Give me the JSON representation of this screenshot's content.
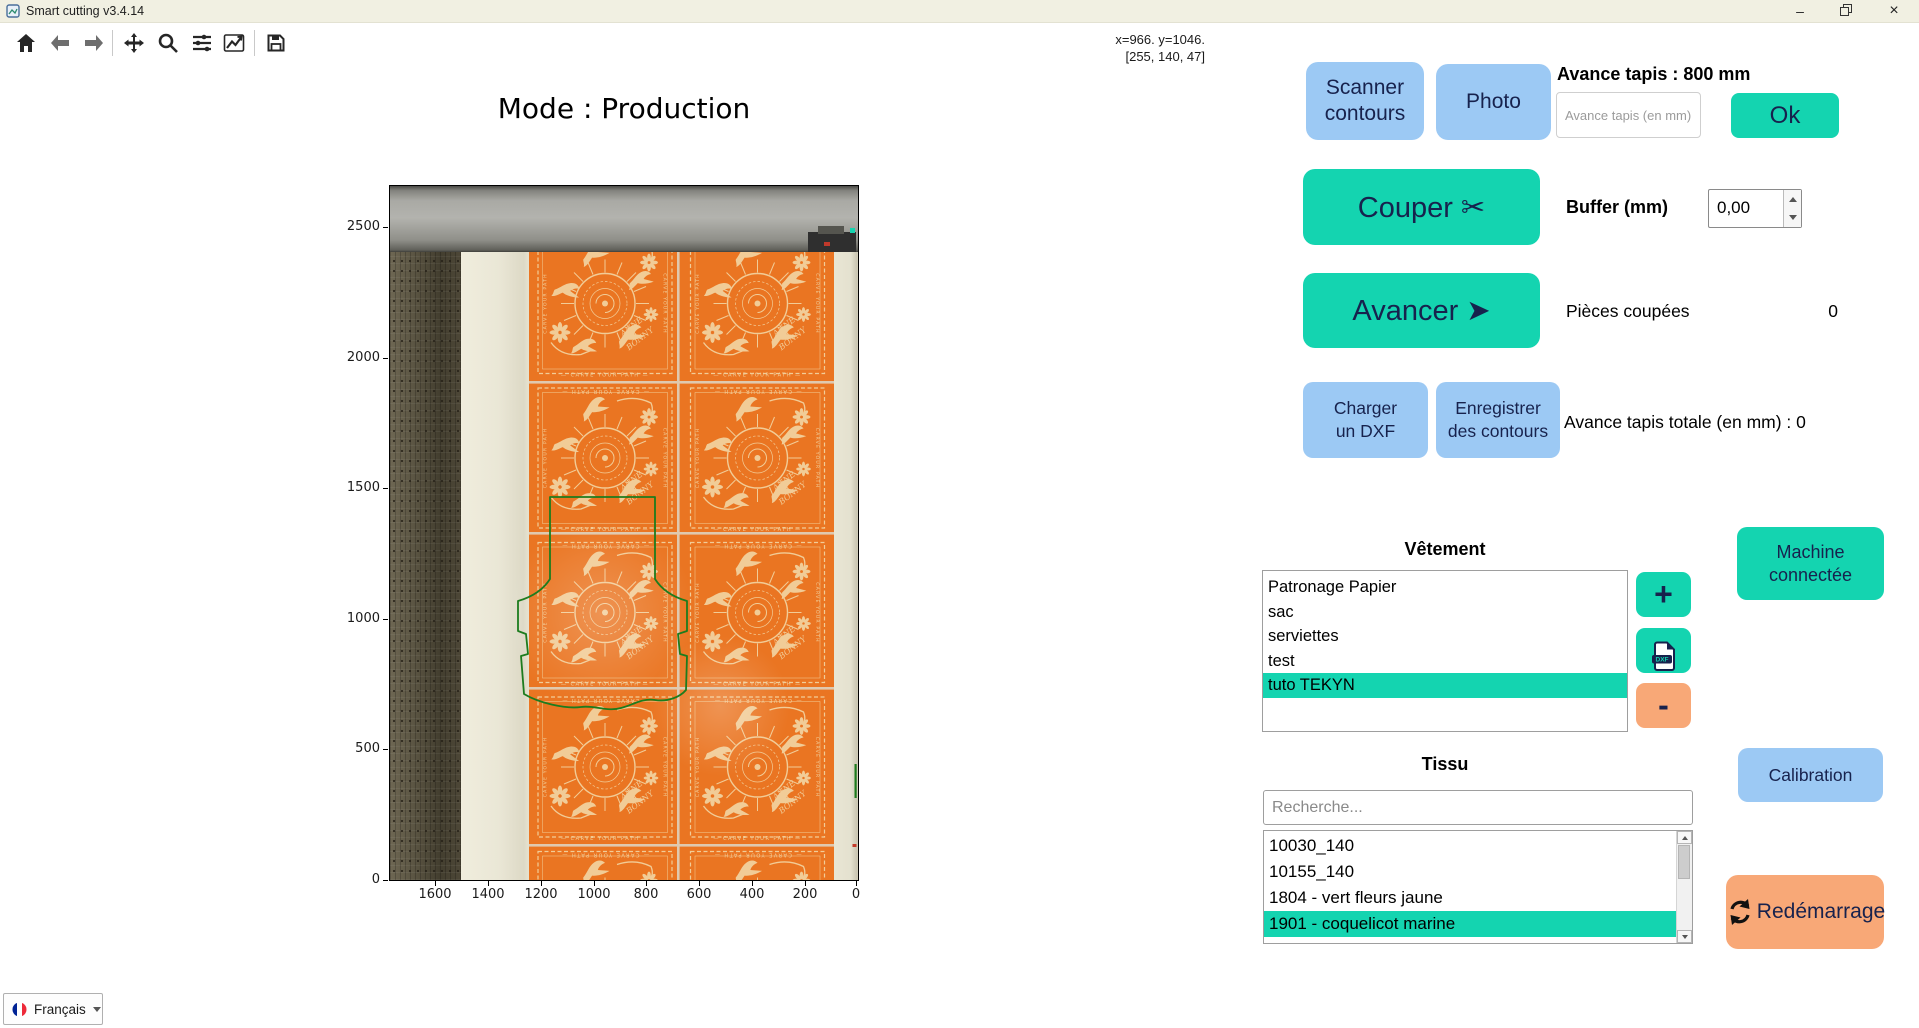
{
  "window": {
    "title": "Smart cutting v3.4.14",
    "minimize": "–",
    "close": "×"
  },
  "toolbar": {
    "icons": [
      "home",
      "back",
      "forward",
      "pan",
      "zoom",
      "subplots",
      "customize",
      "save"
    ]
  },
  "readout": {
    "line1": "x=966. y=1046.",
    "line2": "[255, 140, 47]"
  },
  "plot": {
    "title": "Mode : Production",
    "y_ticks": [
      "2500",
      "2000",
      "1500",
      "1000",
      "500",
      "0"
    ],
    "x_ticks": [
      "1600",
      "1400",
      "1200",
      "1000",
      "800",
      "600",
      "400",
      "200",
      "0"
    ]
  },
  "panel": {
    "scanner": "Scanner\ncontours",
    "photo": "Photo",
    "avance_label": "Avance tapis : 800 mm",
    "avance_placeholder": "Avance tapis (en mm)",
    "ok": "Ok",
    "couper": "Couper  ✂",
    "buffer_label": "Buffer (mm)",
    "buffer_value": "0,00",
    "avancer": "Avancer  ➤",
    "pieces_label": "Pièces coupées",
    "pieces_value": "0",
    "charger": "Charger\nun DXF",
    "enregistrer": "Enregistrer\ndes contours",
    "avance_totale": "Avance tapis totale (en mm) : 0",
    "machine": "Machine\nconnectée",
    "calibration": "Calibration",
    "redemarrage": "Redémarrage",
    "add": "+",
    "remove": "-",
    "dxf_icon_label": "DXF"
  },
  "vetement": {
    "title": "Vêtement",
    "items": [
      {
        "label": "Patronage Papier",
        "selected": false
      },
      {
        "label": "sac",
        "selected": false
      },
      {
        "label": "serviettes",
        "selected": false
      },
      {
        "label": "test",
        "selected": false
      },
      {
        "label": "tuto TEKYN",
        "selected": true
      }
    ]
  },
  "tissu": {
    "title": "Tissu",
    "search_placeholder": "Recherche...",
    "items": [
      {
        "label": "10030_140",
        "selected": false
      },
      {
        "label": "10155_140",
        "selected": false
      },
      {
        "label": "1804 - vert fleurs jaune",
        "selected": false
      },
      {
        "label": "1901 - coquelicot marine",
        "selected": true
      },
      {
        "label": "1904 - Fleurs bleu marine",
        "selected": false,
        "partial": true
      }
    ]
  },
  "language": {
    "label": "Français"
  },
  "colors": {
    "teal": "#14d4b0",
    "blue": "#9cc9f4",
    "salmon": "#f8a877",
    "navy": "#17224d",
    "selection": "#14d4b0",
    "contour_green": "#1d7c1e",
    "fabric_orange": "#ea7522"
  }
}
